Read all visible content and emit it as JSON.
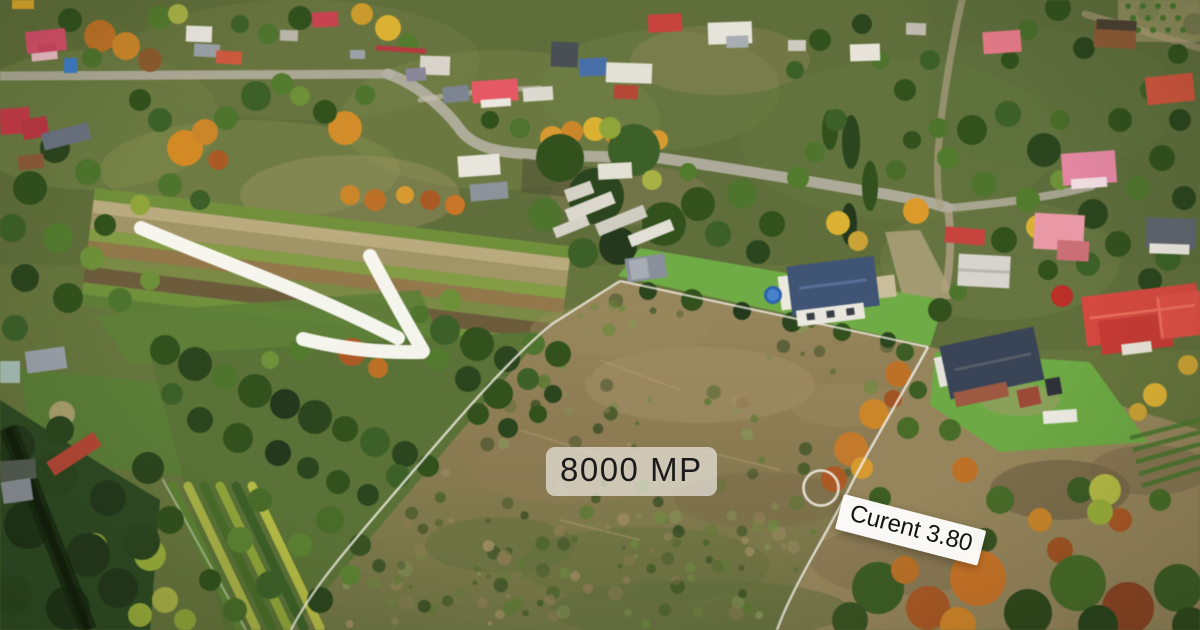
{
  "image": {
    "width": 1200,
    "height": 630,
    "kind": "aerial-drone-photo",
    "season": "autumn"
  },
  "listing": {
    "area_label": "8000 MP",
    "utility_label": "Curent 3.80"
  },
  "overlay": {
    "annotation_color": "#ffffff",
    "area_label_text_color": "#1b1b1b",
    "area_label_background": "rgba(233,229,220,0.72)",
    "utility_label_text_color": "#121212",
    "utility_label_background": "rgba(255,255,255,0.95)",
    "utility_label_rotation_deg": 14.5,
    "boundary_line_color": "#f2efe6",
    "arrow_color": "#fbfaf4",
    "marker_circle_color": "#eeece2"
  },
  "scene_palette": {
    "lawn_green": "#72ab49",
    "scrub_tan": "#95855e",
    "forest_dark": "#24381d",
    "autumn_orange": "#c8862f",
    "roof_red": "#c34451",
    "roof_navy": "#415474",
    "road_gray": "#b6b0a4"
  }
}
